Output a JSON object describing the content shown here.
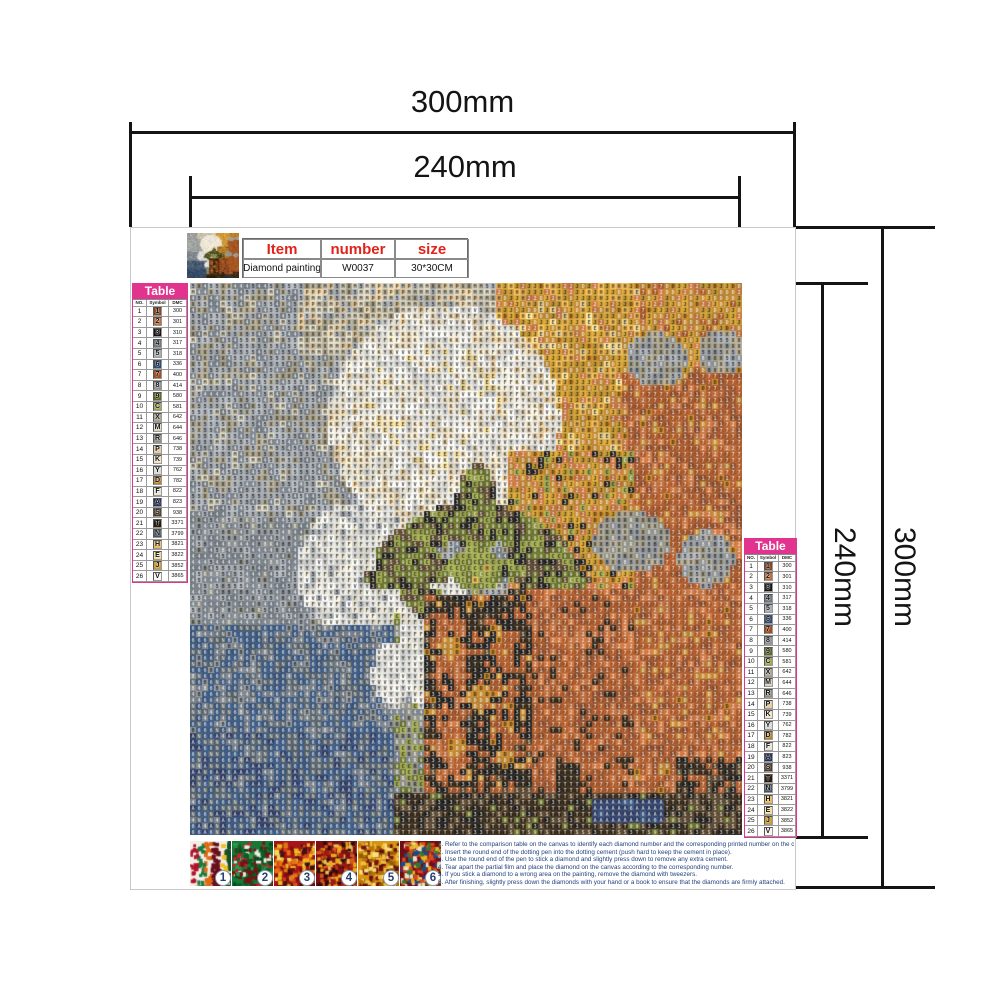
{
  "dims": {
    "top_outer": "300mm",
    "top_inner": "240mm",
    "right_inner": "240mm",
    "right_outer": "300mm"
  },
  "info": {
    "headers": [
      "Item",
      "number",
      "size"
    ],
    "values": [
      "Diamond painting",
      "W0037",
      "30*30CM"
    ],
    "header_color": "#e0241b"
  },
  "legend": {
    "title": "Table",
    "title_bg": "#e0348f",
    "columns": [
      "NO.",
      "Symbol",
      "DMC"
    ],
    "rows": [
      [
        1,
        "1",
        "300"
      ],
      [
        2,
        "2",
        "301"
      ],
      [
        3,
        "3",
        "310"
      ],
      [
        4,
        "4",
        "317"
      ],
      [
        5,
        "5",
        "318"
      ],
      [
        6,
        "6",
        "336"
      ],
      [
        7,
        "7",
        "400"
      ],
      [
        8,
        "8",
        "414"
      ],
      [
        9,
        "9",
        "580"
      ],
      [
        10,
        "C",
        "581"
      ],
      [
        11,
        "X",
        "642"
      ],
      [
        12,
        "M",
        "644"
      ],
      [
        13,
        "R",
        "646"
      ],
      [
        14,
        "P",
        "738"
      ],
      [
        15,
        "K",
        "739"
      ],
      [
        16,
        "Y",
        "762"
      ],
      [
        17,
        "D",
        "782"
      ],
      [
        18,
        "F",
        "822"
      ],
      [
        19,
        "A",
        "823"
      ],
      [
        20,
        "S",
        "938"
      ],
      [
        21,
        "T",
        "3371"
      ],
      [
        22,
        "N",
        "3799"
      ],
      [
        23,
        "H",
        "3821"
      ],
      [
        24,
        "E",
        "3822"
      ],
      [
        25,
        "J",
        "3852"
      ],
      [
        26,
        "V",
        "3865"
      ]
    ]
  },
  "palette": {
    "1": "#8A4522",
    "2": "#C06A35",
    "3": "#141210",
    "4": "#6E7680",
    "5": "#A8AEB4",
    "6": "#2C4A74",
    "7": "#A34E1E",
    "8": "#8E9398",
    "9": "#5C661C",
    "C": "#9CA54A",
    "X": "#ACA48C",
    "M": "#D8D2BC",
    "R": "#8B8C80",
    "P": "#E7CC9E",
    "K": "#F3E3C4",
    "Y": "#DBDBD8",
    "D": "#BC7E20",
    "F": "#EAE6D6",
    "A": "#22325E",
    "S": "#4E3A22",
    "T": "#2A1C0C",
    "N": "#46525C",
    "H": "#EEB650",
    "E": "#F3DC9A",
    "J": "#CE9D2E",
    "V": "#FAF8F0"
  },
  "artwork": {
    "grid": 92,
    "regions": [
      {
        "t": "r",
        "x": 0,
        "y": 0,
        "w": 1,
        "h": 1,
        "m": [
          [
            "5",
            5
          ],
          [
            "4",
            2
          ],
          [
            "X",
            2
          ],
          [
            "M",
            1
          ]
        ]
      },
      {
        "t": "r",
        "x": 0.2,
        "y": 0,
        "w": 0.5,
        "h": 0.13,
        "m": [
          [
            "M",
            4
          ],
          [
            "P",
            2
          ],
          [
            "X",
            2
          ],
          [
            "5",
            1
          ]
        ]
      },
      {
        "t": "r",
        "x": 0.55,
        "y": 0,
        "w": 0.45,
        "h": 0.42,
        "m": [
          [
            "J",
            4
          ],
          [
            "H",
            2
          ],
          [
            "D",
            2
          ],
          [
            "E",
            1
          ],
          [
            "2",
            1
          ]
        ]
      },
      {
        "t": "r",
        "x": 0.82,
        "y": 0,
        "w": 0.18,
        "h": 0.26,
        "m": [
          [
            "D",
            3
          ],
          [
            "J",
            3
          ],
          [
            "2",
            2
          ],
          [
            "7",
            1
          ]
        ]
      },
      {
        "t": "e",
        "cx": 0.46,
        "cy": 0.25,
        "rx": 0.21,
        "ry": 0.21,
        "m": [
          [
            "V",
            3
          ],
          [
            "K",
            3
          ],
          [
            "F",
            2
          ],
          [
            "Y",
            2
          ],
          [
            "P",
            1
          ]
        ]
      },
      {
        "t": "e",
        "cx": 0.44,
        "cy": 0.215,
        "rx": 0.12,
        "ry": 0.13,
        "m": [
          [
            "V",
            4
          ],
          [
            "Y",
            3
          ],
          [
            "K",
            2
          ],
          [
            "E",
            1
          ]
        ]
      },
      {
        "t": "r",
        "x": 0.78,
        "y": 0.16,
        "w": 0.22,
        "h": 0.78,
        "m": [
          [
            "7",
            5
          ],
          [
            "2",
            2
          ],
          [
            "1",
            2
          ],
          [
            "D",
            1
          ]
        ]
      },
      {
        "t": "r",
        "x": 0.58,
        "y": 0.3,
        "w": 0.22,
        "h": 0.26,
        "m": [
          [
            "J",
            3
          ],
          [
            "D",
            3
          ],
          [
            "2",
            2
          ],
          [
            "3",
            1
          ],
          [
            "C",
            1
          ]
        ]
      },
      {
        "t": "e",
        "cx": 0.845,
        "cy": 0.14,
        "rx": 0.055,
        "ry": 0.05,
        "m": [
          [
            "X",
            3
          ],
          [
            "8",
            2
          ],
          [
            "5",
            2
          ]
        ]
      },
      {
        "t": "e",
        "cx": 0.965,
        "cy": 0.125,
        "rx": 0.045,
        "ry": 0.04,
        "m": [
          [
            "X",
            3
          ],
          [
            "8",
            2
          ],
          [
            "5",
            2
          ]
        ]
      },
      {
        "t": "r",
        "x": 0,
        "y": 0.42,
        "w": 0.38,
        "h": 0.26,
        "m": [
          [
            "4",
            5
          ],
          [
            "8",
            2
          ],
          [
            "5",
            2
          ],
          [
            "R",
            1
          ]
        ]
      },
      {
        "t": "e",
        "cx": 0.3,
        "cy": 0.52,
        "rx": 0.105,
        "ry": 0.12,
        "m": [
          [
            "Y",
            4
          ],
          [
            "V",
            2
          ],
          [
            "F",
            2
          ],
          [
            "5",
            1
          ]
        ]
      },
      {
        "t": "r",
        "x": 0,
        "y": 0.62,
        "w": 0.37,
        "h": 0.38,
        "m": [
          [
            "6",
            4
          ],
          [
            "4",
            2
          ],
          [
            "N",
            2
          ],
          [
            "8",
            1
          ]
        ]
      },
      {
        "t": "r",
        "x": 0,
        "y": 0.81,
        "w": 0.37,
        "h": 0.19,
        "m": [
          [
            "6",
            4
          ],
          [
            "N",
            3
          ],
          [
            "A",
            2
          ],
          [
            "4",
            1
          ]
        ]
      },
      {
        "t": "r",
        "x": 0.37,
        "y": 0.6,
        "w": 0.06,
        "h": 0.4,
        "m": [
          [
            "R",
            3
          ],
          [
            "C",
            2
          ],
          [
            "9",
            2
          ],
          [
            "4",
            2
          ]
        ]
      },
      {
        "t": "e",
        "cx": 0.445,
        "cy": 0.64,
        "rx": 0.065,
        "ry": 0.15,
        "m": [
          [
            "Y",
            4
          ],
          [
            "V",
            3
          ],
          [
            "F",
            2
          ]
        ]
      },
      {
        "t": "e",
        "cx": 0.37,
        "cy": 0.71,
        "rx": 0.04,
        "ry": 0.06,
        "m": [
          [
            "Y",
            3
          ],
          [
            "V",
            2
          ]
        ]
      },
      {
        "t": "e",
        "cx": 0.43,
        "cy": 0.455,
        "rx": 0.105,
        "ry": 0.035,
        "rot": -28,
        "m": [
          [
            "9",
            3
          ],
          [
            "C",
            2
          ],
          [
            "S",
            2
          ],
          [
            "3",
            2
          ]
        ]
      },
      {
        "t": "e",
        "cx": 0.52,
        "cy": 0.415,
        "rx": 0.04,
        "ry": 0.085,
        "m": [
          [
            "9",
            3
          ],
          [
            "C",
            2
          ],
          [
            "S",
            2
          ],
          [
            "3",
            2
          ]
        ]
      },
      {
        "t": "e",
        "cx": 0.6,
        "cy": 0.455,
        "rx": 0.105,
        "ry": 0.035,
        "rot": 28,
        "m": [
          [
            "9",
            3
          ],
          [
            "C",
            2
          ],
          [
            "S",
            2
          ],
          [
            "3",
            2
          ]
        ]
      },
      {
        "t": "e",
        "cx": 0.635,
        "cy": 0.525,
        "rx": 0.09,
        "ry": 0.03,
        "rot": 8,
        "m": [
          [
            "9",
            3
          ],
          [
            "C",
            2
          ],
          [
            "S",
            2
          ],
          [
            "3",
            2
          ]
        ]
      },
      {
        "t": "e",
        "cx": 0.405,
        "cy": 0.525,
        "rx": 0.09,
        "ry": 0.03,
        "rot": -8,
        "m": [
          [
            "9",
            3
          ],
          [
            "C",
            2
          ],
          [
            "S",
            2
          ],
          [
            "3",
            2
          ]
        ]
      },
      {
        "t": "e",
        "cx": 0.45,
        "cy": 0.59,
        "rx": 0.08,
        "ry": 0.03,
        "rot": 30,
        "m": [
          [
            "9",
            3
          ],
          [
            "C",
            2
          ],
          [
            "S",
            2
          ],
          [
            "3",
            2
          ]
        ]
      },
      {
        "t": "e",
        "cx": 0.585,
        "cy": 0.59,
        "rx": 0.08,
        "ry": 0.03,
        "rot": -30,
        "m": [
          [
            "9",
            3
          ],
          [
            "C",
            2
          ],
          [
            "S",
            2
          ],
          [
            "3",
            2
          ]
        ]
      },
      {
        "t": "e",
        "cx": 0.52,
        "cy": 0.52,
        "rx": 0.05,
        "ry": 0.04,
        "m": [
          [
            "C",
            4
          ],
          [
            "9",
            2
          ],
          [
            "H",
            1
          ]
        ]
      },
      {
        "t": "r",
        "x": 0.6,
        "y": 0.55,
        "w": 0.2,
        "h": 0.37,
        "m": [
          [
            "7",
            5
          ],
          [
            "1",
            2
          ],
          [
            "2",
            2
          ],
          [
            "T",
            1
          ]
        ]
      },
      {
        "t": "e",
        "cx": 0.8,
        "cy": 0.47,
        "rx": 0.07,
        "ry": 0.055,
        "m": [
          [
            "8",
            3
          ],
          [
            "X",
            2
          ],
          [
            "R",
            2
          ]
        ]
      },
      {
        "t": "e",
        "cx": 0.935,
        "cy": 0.5,
        "rx": 0.05,
        "ry": 0.05,
        "m": [
          [
            "8",
            3
          ],
          [
            "5",
            2
          ],
          [
            "X",
            2
          ]
        ]
      },
      {
        "t": "r",
        "x": 0.425,
        "y": 0.565,
        "w": 0.195,
        "h": 0.36,
        "m": [
          [
            "3",
            4
          ],
          [
            "T",
            3
          ],
          [
            "S",
            1
          ],
          [
            "7",
            2
          ],
          [
            "D",
            1
          ]
        ]
      },
      {
        "t": "r",
        "x": 0.45,
        "y": 0.6,
        "w": 0.045,
        "h": 0.3,
        "m": [
          [
            "7",
            4
          ],
          [
            "2",
            2
          ],
          [
            "3",
            2
          ]
        ]
      },
      {
        "t": "r",
        "x": 0.545,
        "y": 0.62,
        "w": 0.04,
        "h": 0.25,
        "m": [
          [
            "7",
            3
          ],
          [
            "D",
            2
          ],
          [
            "3",
            2
          ]
        ]
      },
      {
        "t": "e",
        "cx": 0.47,
        "cy": 0.66,
        "rx": 0.02,
        "ry": 0.02,
        "m": [
          [
            "D",
            1
          ]
        ]
      },
      {
        "t": "e",
        "cx": 0.52,
        "cy": 0.75,
        "rx": 0.02,
        "ry": 0.02,
        "m": [
          [
            "D",
            1
          ]
        ]
      },
      {
        "t": "e",
        "cx": 0.48,
        "cy": 0.84,
        "rx": 0.018,
        "ry": 0.018,
        "m": [
          [
            "D",
            1
          ]
        ]
      },
      {
        "t": "r",
        "x": 0.88,
        "y": 0.86,
        "w": 0.12,
        "h": 0.14,
        "m": [
          [
            "T",
            3
          ],
          [
            "S",
            2
          ],
          [
            "3",
            2
          ],
          [
            "7",
            2
          ]
        ]
      },
      {
        "t": "r",
        "x": 0.66,
        "y": 0.875,
        "w": 0.05,
        "h": 0.05,
        "m": [
          [
            "T",
            3
          ],
          [
            "3",
            1
          ]
        ]
      },
      {
        "t": "r",
        "x": 0.37,
        "y": 0.92,
        "w": 0.63,
        "h": 0.08,
        "m": [
          [
            "T",
            4
          ],
          [
            "S",
            3
          ],
          [
            "3",
            2
          ],
          [
            "9",
            1
          ]
        ]
      },
      {
        "t": "r",
        "x": 0.725,
        "y": 0.935,
        "w": 0.13,
        "h": 0.042,
        "m": [
          [
            "A",
            5
          ],
          [
            "6",
            1
          ]
        ]
      }
    ]
  },
  "photos": [
    {
      "label": "1",
      "base": "#F2EFE8",
      "specks": [
        "#B3122A",
        "#1E7A3C",
        "#E06A15",
        "#6A0F1F",
        "#F0C020",
        "#14502A"
      ]
    },
    {
      "label": "2",
      "base": "#157A35",
      "specks": [
        "#0C5C26",
        "#2A9A4C",
        "#C22030",
        "#EFEFE6",
        "#7A1015",
        "#0A4A1E"
      ]
    },
    {
      "label": "3",
      "base": "#A81318",
      "specks": [
        "#E07812",
        "#F0B81E",
        "#7A0D10",
        "#D8461A",
        "#401013",
        "#F5D860"
      ]
    },
    {
      "label": "4",
      "base": "#7C0F13",
      "specks": [
        "#D8581C",
        "#F0A81A",
        "#9A1B10",
        "#E8C25A",
        "#2A0A0C",
        "#B33A12"
      ]
    },
    {
      "label": "5",
      "base": "#D89410",
      "specks": [
        "#B87208",
        "#F0C040",
        "#7A1010",
        "#F8E080",
        "#905C06",
        "#601010"
      ]
    },
    {
      "label": "6",
      "base": "#6E0D13",
      "specks": [
        "#B3121C",
        "#2A7A35",
        "#E8B520",
        "#1A4A8A",
        "#D84A1A",
        "#F0E0C0"
      ]
    }
  ],
  "instructions": {
    "lines": [
      "1. Refer to the comparison table on the canvas to identify each diamond number and the corresponding printed number on the canvas.",
      "2. Insert the round end of the dotting pen into the dotting cement (push hard to keep the cement in place).",
      "3. Use the round end of the pen to stick a diamond and slightly press down to remove any extra cement.",
      "4. Tear apart the partial film and place the diamond on the canvas according to the corresponding number.",
      "5. If you stick a diamond to a wrong area on the painting, remove the diamond with tweezers.",
      "6. After finishing, slightly press down the diamonds with your hand or a book to ensure that the diamonds are firmly attached."
    ]
  }
}
